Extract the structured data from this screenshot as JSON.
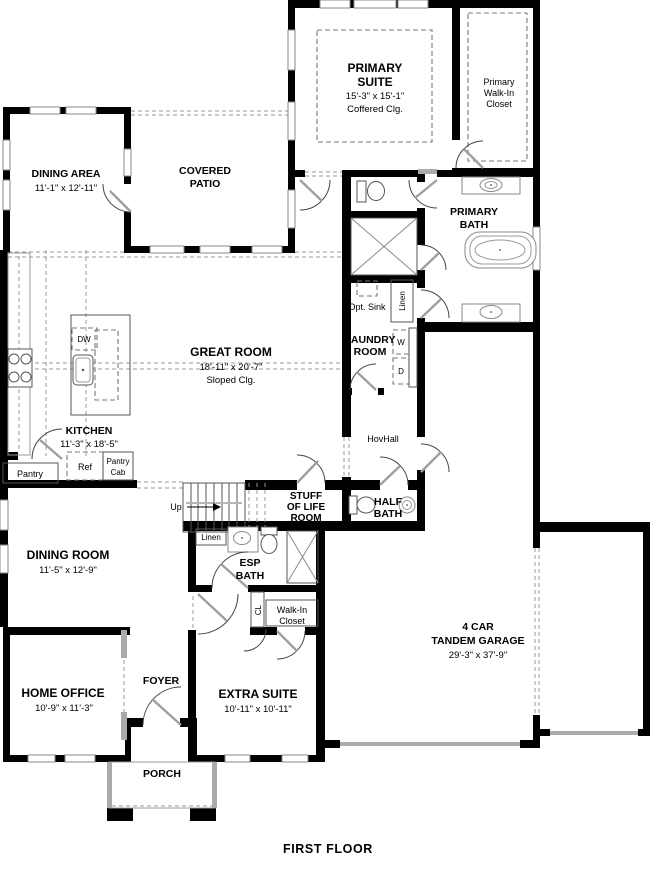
{
  "labels": {
    "dining_area": "DINING AREA",
    "dining_area_dims": "11'-1\" x 12'-11\"",
    "covered_patio_1": "COVERED",
    "covered_patio_2": "PATIO",
    "primary_suite_1": "PRIMARY",
    "primary_suite_2": "SUITE",
    "primary_suite_dims": "15'-3\" x 15'-1\"",
    "primary_suite_clg": "Coffered Clg.",
    "primary_closet_1": "Primary",
    "primary_closet_2": "Walk-In",
    "primary_closet_3": "Closet",
    "primary_bath_1": "PRIMARY",
    "primary_bath_2": "BATH",
    "opt_sink": "Opt. Sink",
    "linen_laundry": "Linen",
    "laundry_1": "LAUNDRY",
    "laundry_2": "ROOM",
    "washer": "W",
    "dryer": "D",
    "great_room": "GREAT ROOM",
    "great_room_dims": "18'-11\" x 20'-7\"",
    "great_room_clg": "Sloped Clg.",
    "kitchen": "KITCHEN",
    "kitchen_dims": "11'-3\" x 18'-5\"",
    "dw": "DW",
    "pantry": "Pantry",
    "ref": "Ref",
    "pantry_cab_1": "Pantry",
    "pantry_cab_2": "Cab",
    "hovhall": "HovHall",
    "up": "Up",
    "stuff_1": "STUFF",
    "stuff_2": "OF LIFE",
    "stuff_3": "ROOM",
    "half_bath_1": "HALF",
    "half_bath_2": "BATH",
    "dining_room": "DINING ROOM",
    "dining_room_dims": "11'-5\" x 12'-9\"",
    "linen_esp": "Linen",
    "esp_bath_1": "ESP",
    "esp_bath_2": "BATH",
    "cl": "CL",
    "walk_in_1": "Walk-In",
    "walk_in_2": "Closet",
    "home_office": "HOME OFFICE",
    "home_office_dims": "10'-9\" x 11'-3\"",
    "foyer": "FOYER",
    "extra_suite": "EXTRA SUITE",
    "extra_suite_dims": "10'-11\" x 10'-11\"",
    "porch": "PORCH",
    "garage_1": "4 CAR",
    "garage_2": "TANDEM GARAGE",
    "garage_dims": "29'-3\" x 37'-9\"",
    "floor_title": "FIRST FLOOR"
  }
}
